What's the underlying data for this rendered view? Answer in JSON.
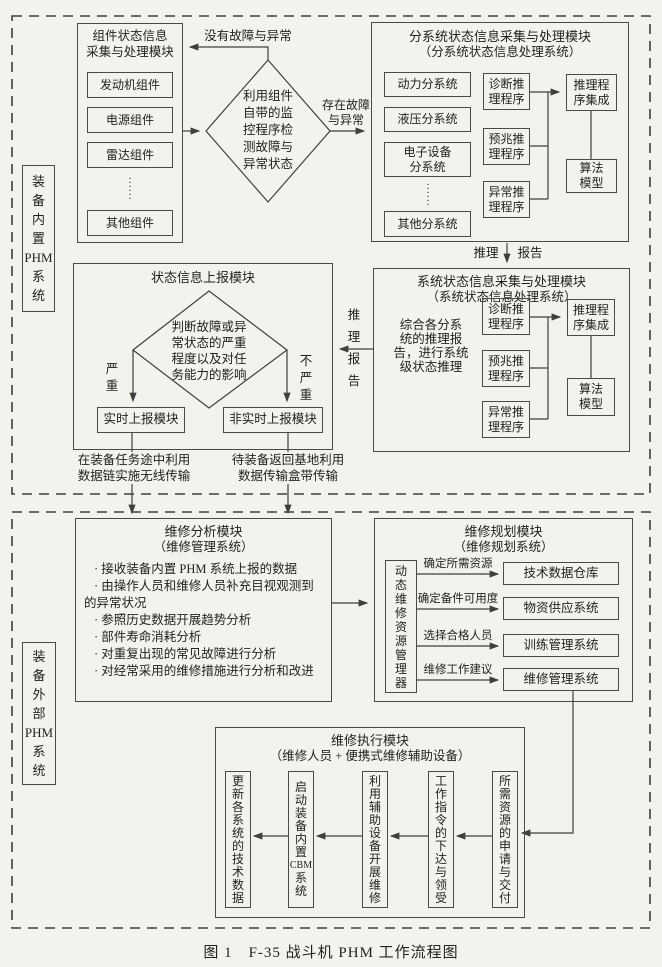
{
  "colors": {
    "paper": "#f4f2ed",
    "line": "#3f3f3f",
    "text": "#222222"
  },
  "caption": "图 1　F-35 战斗机 PHM 工作流程图",
  "top": {
    "side_label": [
      "装",
      "备",
      "内",
      "置",
      "PHM",
      "系",
      "统"
    ],
    "component_module": {
      "title": [
        "组件状态信息",
        "采集与处理模块"
      ],
      "items": [
        "发动机组件",
        "电源组件",
        "雷达组件",
        "其他组件"
      ],
      "dots": [
        "·",
        "·",
        "·",
        "·",
        "·",
        "·"
      ]
    },
    "monitor_decision": [
      "利用组件",
      "自带的监",
      "控程序检",
      "测故障与",
      "异常状态"
    ],
    "no_fault_label": "没有故障与异常",
    "fault_label": [
      "存在故障",
      "与异常"
    ],
    "subsystem_module": {
      "title": "分系统状态信息采集与处理模块",
      "subtitle": "（分系统状态信息处理系统）",
      "subsystems": [
        "动力分系统",
        "液压分系统",
        "其他分系统"
      ],
      "subsystem_two_line": [
        "电子设备",
        "分系统"
      ],
      "dots": [
        "·",
        "·",
        "·",
        "·",
        "·",
        "·"
      ],
      "programs": [
        [
          "诊断推",
          "理程序"
        ],
        [
          "预兆推",
          "理程序"
        ],
        [
          "异常推",
          "理程序"
        ]
      ],
      "integration": [
        "推理程",
        "序集成"
      ],
      "algorithm": [
        "算法",
        "模型"
      ]
    },
    "reasoning_label": "推理",
    "report_label": "报告",
    "system_module": {
      "title": "系统状态信息采集与处理模块",
      "subtitle": "（系统状态信息处理系统）",
      "description": [
        "综合各分系",
        "统的推理报",
        "告，进行系统",
        "级状态推理"
      ],
      "programs": [
        [
          "诊断推",
          "理程序"
        ],
        [
          "预兆推",
          "理程序"
        ],
        [
          "异常推",
          "理程序"
        ]
      ],
      "integration": [
        "推理程",
        "序集成"
      ],
      "algorithm": [
        "算法",
        "模型"
      ]
    },
    "reasoning_report_vertical": [
      "推",
      "理",
      "报",
      "告"
    ],
    "report_module": {
      "title": "状态信息上报模块",
      "severity_decision": [
        "判断故障或异",
        "常状态的严重",
        "程度以及对任",
        "务能力的影响"
      ],
      "severe": [
        "严",
        "重"
      ],
      "not_severe": [
        "不",
        "严",
        "重"
      ],
      "realtime": "实时上报模块",
      "non_realtime": "非实时上报模块"
    },
    "wireless_note": [
      "在装备任务途中利用",
      "数据链实施无线传输"
    ],
    "cartridge_note": [
      "待装备返回基地利用",
      "数据传输盒带传输"
    ]
  },
  "bottom": {
    "side_label": [
      "装",
      "备",
      "外",
      "部",
      "PHM",
      "系",
      "统"
    ],
    "analysis_module": {
      "title": "维修分析模块",
      "subtitle": "（维修管理系统）",
      "bullets": [
        "· 接收装备内置 PHM 系统上报的数据",
        "· 由操作人员和维修人员补充目视观测到的异常状况",
        "· 参照历史数据开展趋势分析",
        "· 部件寿命消耗分析",
        "· 对重复出现的常见故障进行分析",
        "· 对经常采用的维修措施进行分析和改进"
      ]
    },
    "planning_module": {
      "title": "维修规划模块",
      "subtitle": "（维修规划系统）",
      "manager": [
        "动",
        "态",
        "维",
        "修",
        "资",
        "源",
        "管",
        "理",
        "器"
      ],
      "rows": [
        {
          "label": "确定所需资源",
          "target": "技术数据仓库"
        },
        {
          "label": "确定备件可用度",
          "target": "物资供应系统"
        },
        {
          "label": "选择合格人员",
          "target": "训练管理系统"
        },
        {
          "label": "维修工作建议",
          "target": "维修管理系统"
        }
      ]
    },
    "execution_module": {
      "title": "维修执行模块",
      "subtitle": "（维修人员 + 便携式维修辅助设备）",
      "steps": [
        [
          "所",
          "需",
          "资",
          "源",
          "的",
          "申",
          "请",
          "与",
          "交",
          "付"
        ],
        [
          "工",
          "作",
          "指",
          "令",
          "的",
          "下",
          "达",
          "与",
          "领",
          "受"
        ],
        [
          "利",
          "用",
          "辅",
          "助",
          "设",
          "备",
          "开",
          "展",
          "维",
          "修"
        ],
        [
          "启",
          "动",
          "装",
          "备",
          "内",
          "置",
          "CBM",
          "系",
          "统"
        ],
        [
          "更",
          "新",
          "各",
          "系",
          "统",
          "的",
          "技",
          "术",
          "数",
          "据"
        ]
      ]
    }
  }
}
